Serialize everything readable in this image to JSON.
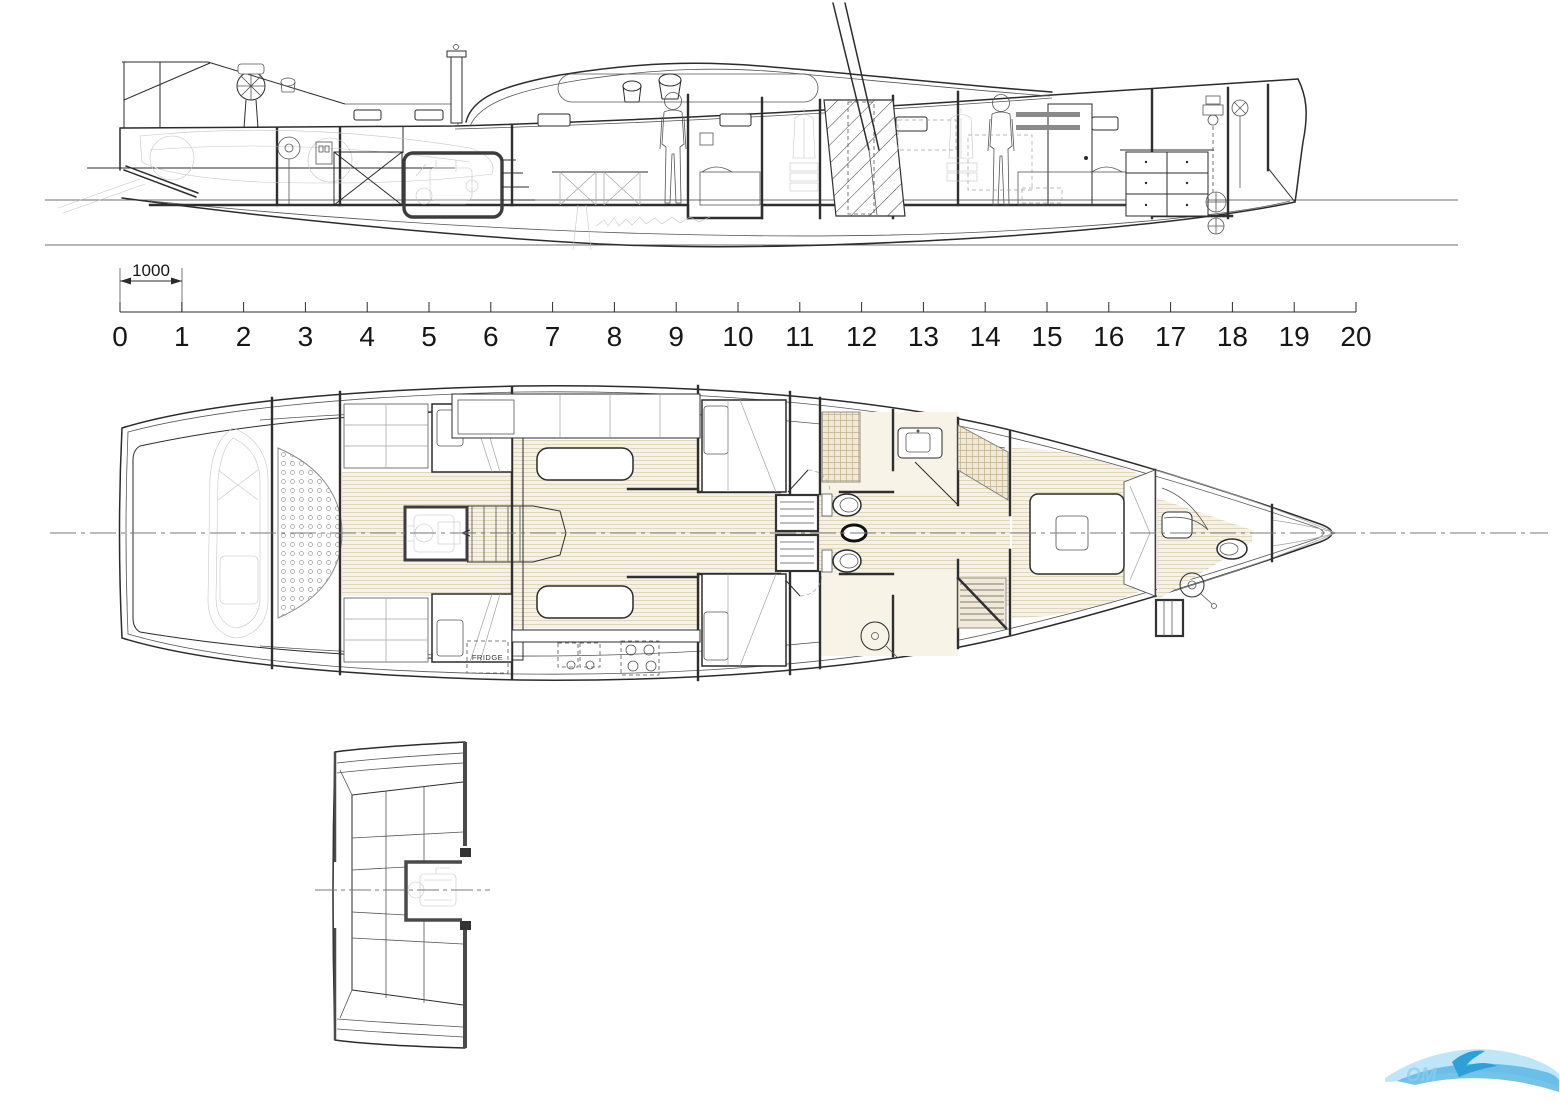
{
  "ruler": {
    "segment_label": "1000",
    "tick_labels": [
      "0",
      "1",
      "2",
      "3",
      "4",
      "5",
      "6",
      "7",
      "8",
      "9",
      "10",
      "11",
      "12",
      "13",
      "14",
      "15",
      "16",
      "17",
      "18",
      "19",
      "20"
    ]
  },
  "plan": {
    "fridge_label": "FRIDGE"
  },
  "logo": {
    "partial_text": "OM"
  },
  "colors": {
    "line": "#2b2b2b",
    "faint_line": "#a3a3a3",
    "wood_floor": "#f6f1e5",
    "wood_stripe": "#ddcfae",
    "tile": "#c3b188",
    "logo_light_blue": "#b8e2f8",
    "logo_mid_blue": "#5bb8e6",
    "logo_dark_blue": "#2f9fd8"
  }
}
